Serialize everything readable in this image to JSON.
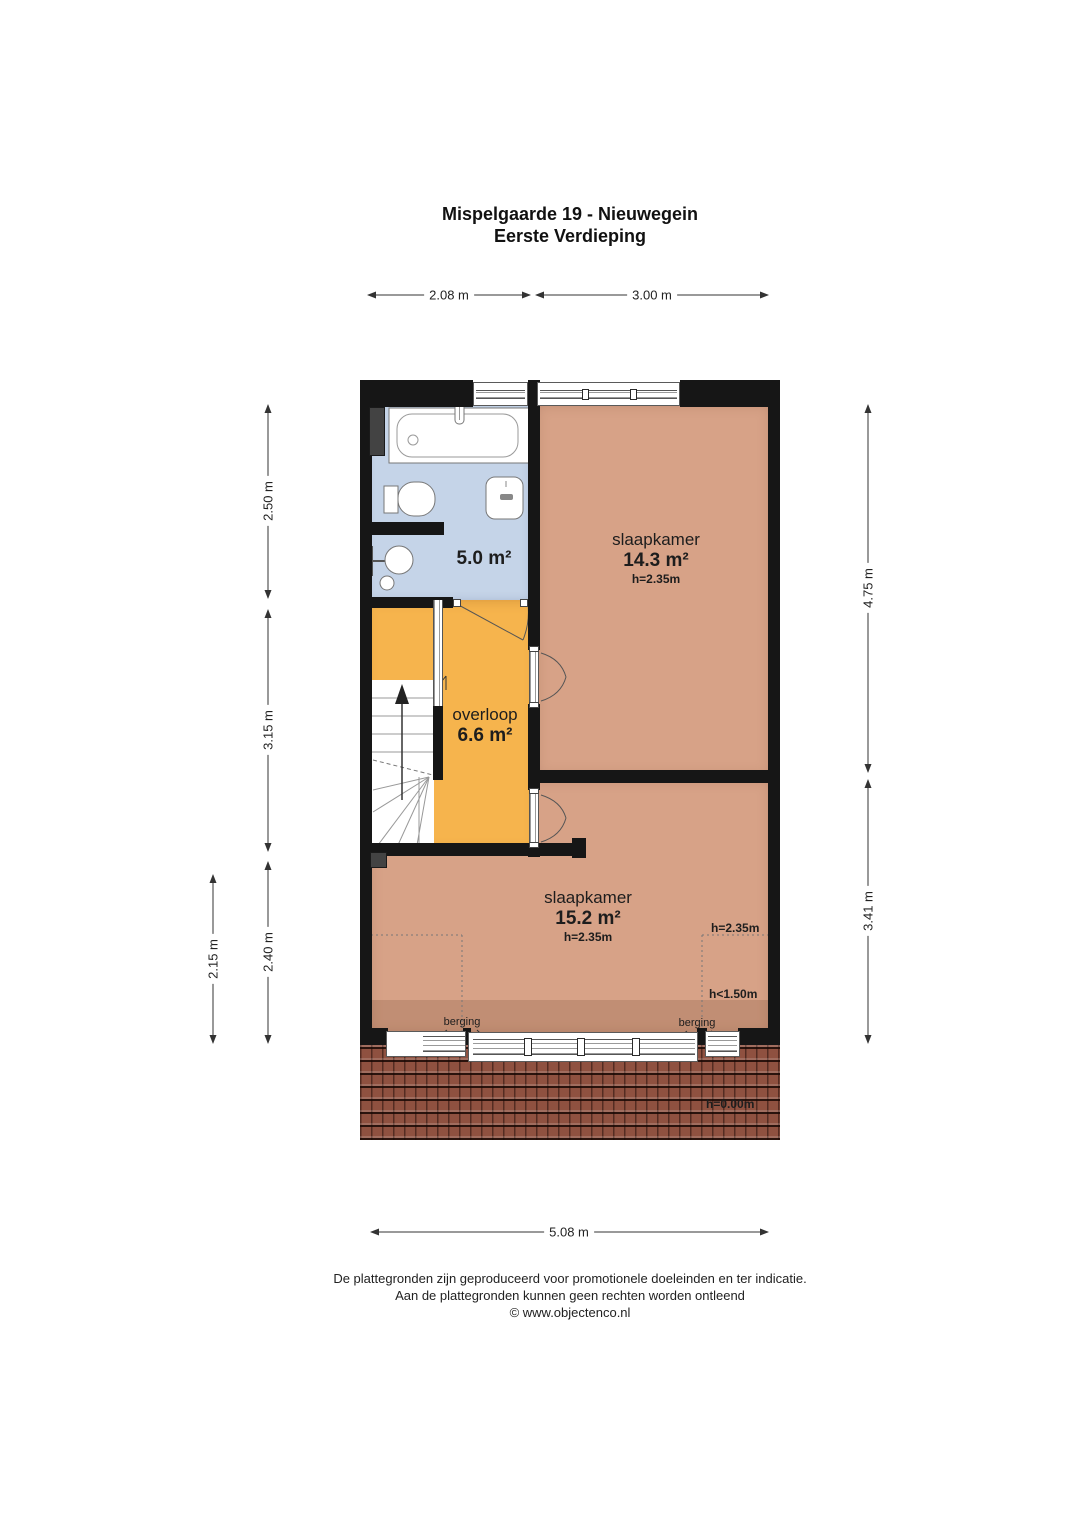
{
  "title": {
    "line1": "Mispelgaarde 19 - Nieuwegein",
    "line2": "Eerste Verdieping"
  },
  "dims": {
    "top_left": "2.08 m",
    "top_right": "3.00 m",
    "left_1": "2.50 m",
    "left_2": "3.15 m",
    "left_3": "2.40 m",
    "left_outer": "2.15 m",
    "right_1": "4.75 m",
    "right_2": "3.41 m",
    "bottom": "5.08 m"
  },
  "rooms": {
    "bathroom": {
      "area": "5.0 m²"
    },
    "bedroom_top": {
      "name": "slaapkamer",
      "area": "14.3 m²",
      "height": "h=2.35m"
    },
    "landing": {
      "name": "overloop",
      "area": "6.6 m²"
    },
    "bedroom_bottom": {
      "name": "slaapkamer",
      "area": "15.2 m²",
      "height": "h=2.35m"
    }
  },
  "annotations": {
    "berging_left": "berging",
    "berging_right": "berging",
    "h_235": "h=2.35m",
    "h_150": "h<1.50m",
    "h_000": "h=0.00m"
  },
  "footer": {
    "line1": "De plattegronden zijn geproduceerd voor promotionele doeleinden en ter indicatie.",
    "line2": "Aan de plattegronden kunnen geen rechten worden ontleend",
    "line3": "© www.objectenco.nl"
  },
  "colors": {
    "bedroom": "#d7a287",
    "landing": "#f6b44d",
    "bathroom": "#c5d4e8",
    "wall": "#161616",
    "roof": "#8f5140"
  }
}
